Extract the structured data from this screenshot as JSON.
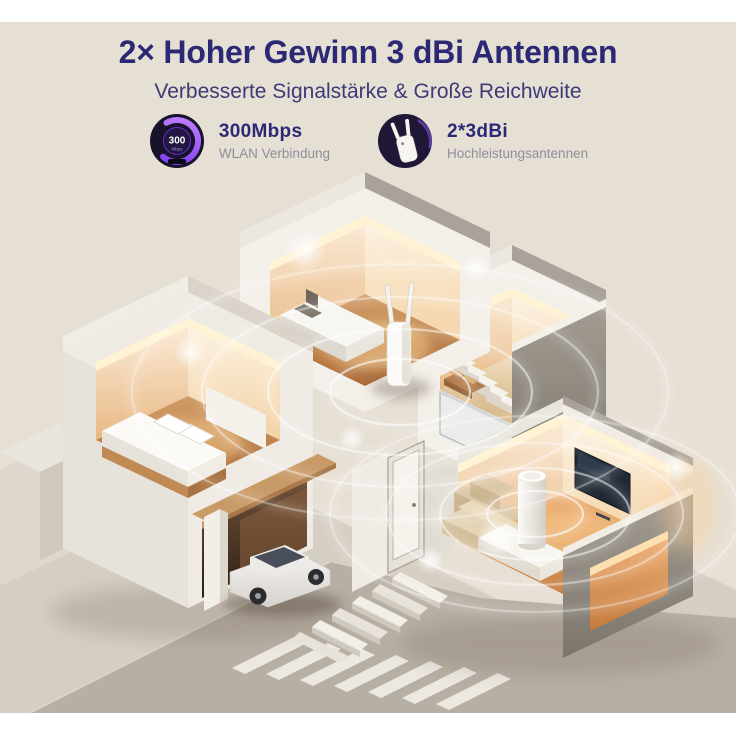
{
  "colors": {
    "background": "#e6dfd4",
    "strip": "#ffffff",
    "title": "#2b2876",
    "subtitle": "#3d3a78",
    "feature_title": "#2b2876",
    "feature_subtitle": "#8f8e9a",
    "accent_purple": "#7c3aed",
    "signal": "#ffffff",
    "warm_light": "#ffd89a"
  },
  "header": {
    "title": "2× Hoher Gewinn 3 dBi Antennen",
    "subtitle": "Verbesserte Signalstärke & Große Reichweite"
  },
  "features": [
    {
      "icon": "speed-gauge-icon",
      "gauge_value": "300",
      "gauge_unit": "Mbps",
      "title": "300Mbps",
      "subtitle": "WLAN Verbindung"
    },
    {
      "icon": "wifi-repeater-icon",
      "title": "2*3dBi",
      "subtitle": "Hochleistungsantennen"
    }
  ],
  "scene": {
    "description": "Isometrisches Schnittmodell eines Hauses mit WLAN-Abdeckung",
    "objects": [
      "wifi-repeater-device",
      "router-cylinder",
      "desk",
      "bed",
      "stairs",
      "sofa",
      "tv",
      "car",
      "garage",
      "front-door",
      "outdoor-steps",
      "crosswalk",
      "signal-ripples"
    ]
  }
}
